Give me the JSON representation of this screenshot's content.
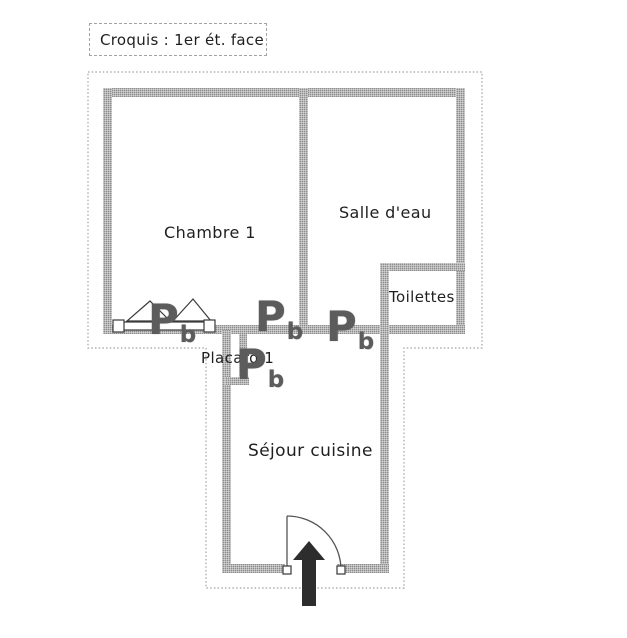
{
  "title": {
    "label": "Croquis : 1er ét. face"
  },
  "rooms": [
    {
      "name": "chambre-1",
      "label": "Chambre 1"
    },
    {
      "name": "salle-deau",
      "label": "Salle d'eau"
    },
    {
      "name": "toilettes",
      "label": "Toilettes"
    },
    {
      "name": "placard-1",
      "label": "Placard 1"
    },
    {
      "name": "sejour-cuisine",
      "label": "Séjour cuisine"
    }
  ],
  "symbols": {
    "door": {
      "main": "P",
      "sub": "b"
    },
    "door_marker_count": 4
  },
  "colors": {
    "background": "#ffffff",
    "wall": "#a6a6a6",
    "outer_outline": "#b0b0b0",
    "label_text": "#1f1f1f",
    "door_marker": "#5c5c5c",
    "entrance_arrow": "#2d2d2d"
  }
}
